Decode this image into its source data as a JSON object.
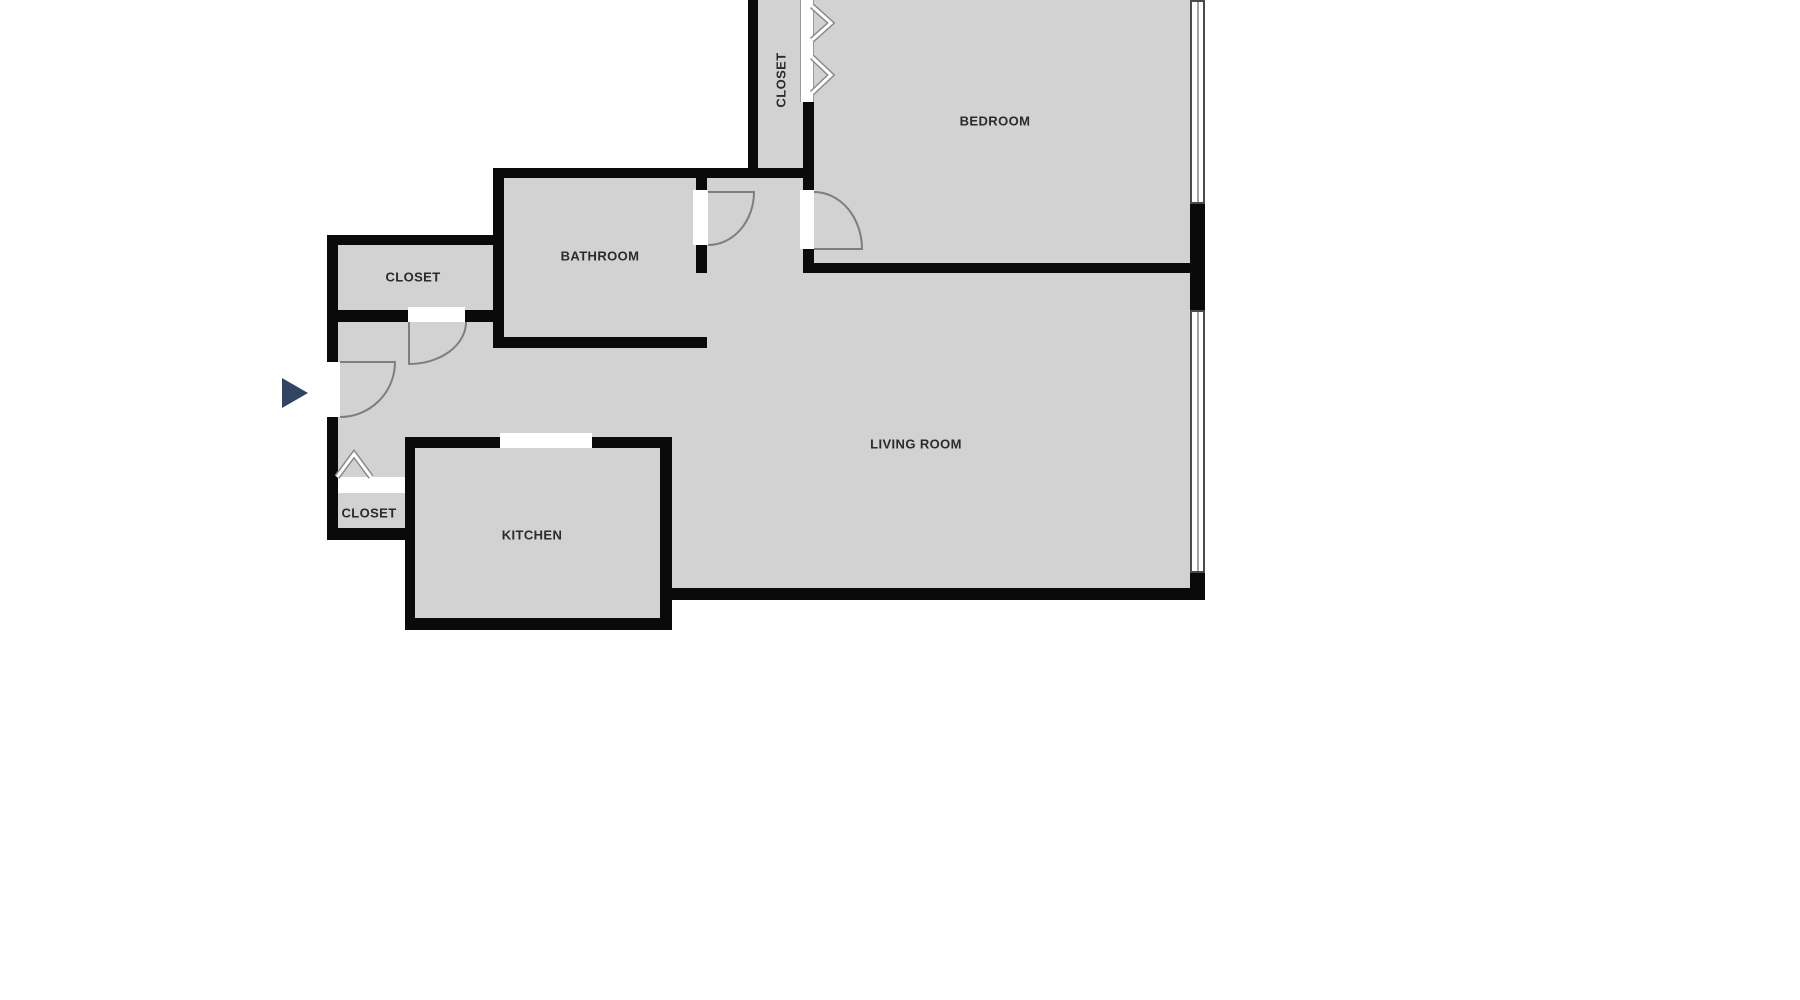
{
  "floorplan": {
    "rooms": {
      "closet_top": {
        "label": "CLOSET"
      },
      "bedroom": {
        "label": "BEDROOM"
      },
      "bathroom": {
        "label": "BATHROOM"
      },
      "closet_left": {
        "label": "CLOSET"
      },
      "living_room": {
        "label": "LIVING ROOM"
      },
      "closet_bottom": {
        "label": "CLOSET"
      },
      "kitchen": {
        "label": "KITCHEN"
      }
    },
    "colors": {
      "room_fill": "#d2d2d2",
      "wall": "#0a0a0a",
      "door_arc": "#7e7e7e",
      "entry_marker": "#324463",
      "label_text": "#2b2b2b",
      "background": "#ffffff",
      "window_border": "#4a4a4a"
    },
    "icons": {
      "entry_marker": "right-pointing-triangle",
      "bifold_door": "double-chevron-right",
      "closet_door": "chevron-up",
      "door_swing": "quarter-arc",
      "window": "double-line-strip"
    },
    "counts": {
      "windows": 2,
      "door_swings": 4
    }
  }
}
